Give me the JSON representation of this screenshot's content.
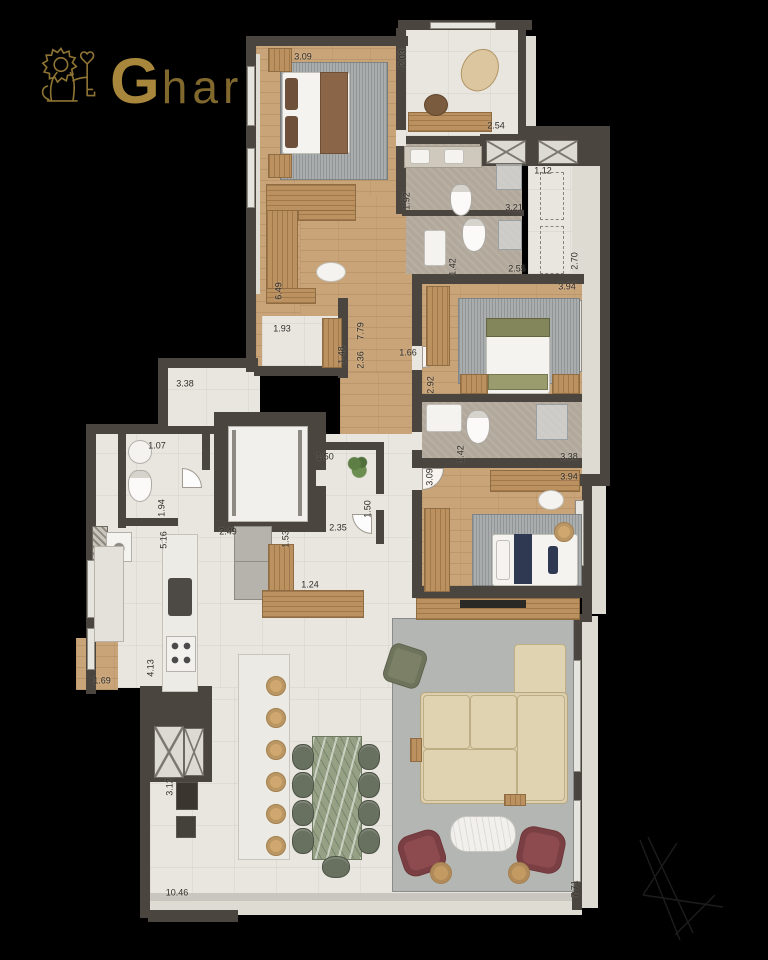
{
  "logo": {
    "brand_g": "G",
    "brand_rest": "har",
    "icon": "lion-with-key",
    "gold": "#a8873c"
  },
  "plan": {
    "colors": {
      "background": "#000000",
      "wall": "#4a453e",
      "wood_floor": "#c9a478",
      "tile_floor": "#e9e6e0",
      "stone_floor": "#b2a89b",
      "rug": "#a9adad",
      "sofa_beige": "#dccfad",
      "bed_green": "#83855a",
      "bed_navy": "#2f3a52",
      "chair_maroon": "#8d4a4f",
      "dining_marble_green": "#95a084"
    },
    "dimensions": [
      {
        "label": "3.09",
        "x": 303,
        "y": 57,
        "v": 0
      },
      {
        "label": "2.03",
        "x": 403,
        "y": 58,
        "v": 1
      },
      {
        "label": "2.54",
        "x": 496,
        "y": 126,
        "v": 0
      },
      {
        "label": "1.92",
        "x": 407,
        "y": 201,
        "v": 1
      },
      {
        "label": "3.21",
        "x": 514,
        "y": 208,
        "v": 0
      },
      {
        "label": "1.12",
        "x": 543,
        "y": 171,
        "v": 0
      },
      {
        "label": "2.70",
        "x": 575,
        "y": 261,
        "v": 1
      },
      {
        "label": "2.55",
        "x": 517,
        "y": 269,
        "v": 0
      },
      {
        "label": "3.94",
        "x": 567,
        "y": 287,
        "v": 0
      },
      {
        "label": "2.92",
        "x": 431,
        "y": 385,
        "v": 1
      },
      {
        "label": "1.42",
        "x": 453,
        "y": 267,
        "v": 1
      },
      {
        "label": "6.49",
        "x": 279,
        "y": 291,
        "v": 1
      },
      {
        "label": "1.93",
        "x": 282,
        "y": 329,
        "v": 0
      },
      {
        "label": "1.48",
        "x": 342,
        "y": 355,
        "v": 1
      },
      {
        "label": "7.79",
        "x": 361,
        "y": 331,
        "v": 1
      },
      {
        "label": "2.36",
        "x": 361,
        "y": 360,
        "v": 1
      },
      {
        "label": "1.66",
        "x": 408,
        "y": 353,
        "v": 0
      },
      {
        "label": "3.38",
        "x": 185,
        "y": 384,
        "v": 0
      },
      {
        "label": "1.07",
        "x": 157,
        "y": 446,
        "v": 0
      },
      {
        "label": "1.94",
        "x": 162,
        "y": 508,
        "v": 1
      },
      {
        "label": "5.16",
        "x": 164,
        "y": 540,
        "v": 1
      },
      {
        "label": "2.49",
        "x": 228,
        "y": 532,
        "v": 0
      },
      {
        "label": "1.53",
        "x": 286,
        "y": 539,
        "v": 1
      },
      {
        "label": "1.50",
        "x": 325,
        "y": 457,
        "v": 0
      },
      {
        "label": "1.50",
        "x": 368,
        "y": 509,
        "v": 1
      },
      {
        "label": "2.35",
        "x": 338,
        "y": 528,
        "v": 0
      },
      {
        "label": "1.24",
        "x": 310,
        "y": 585,
        "v": 0
      },
      {
        "label": "4.13",
        "x": 151,
        "y": 668,
        "v": 1
      },
      {
        "label": "1.69",
        "x": 102,
        "y": 681,
        "v": 0
      },
      {
        "label": "3.12",
        "x": 170,
        "y": 787,
        "v": 1
      },
      {
        "label": "10.46",
        "x": 177,
        "y": 893,
        "v": 0
      },
      {
        "label": "7.71",
        "x": 575,
        "y": 889,
        "v": 1
      },
      {
        "label": "1.42",
        "x": 461,
        "y": 454,
        "v": 1
      },
      {
        "label": "3.09",
        "x": 430,
        "y": 477,
        "v": 1
      },
      {
        "label": "3.38",
        "x": 569,
        "y": 457,
        "v": 0
      },
      {
        "label": "3.94",
        "x": 569,
        "y": 477,
        "v": 0
      }
    ]
  }
}
